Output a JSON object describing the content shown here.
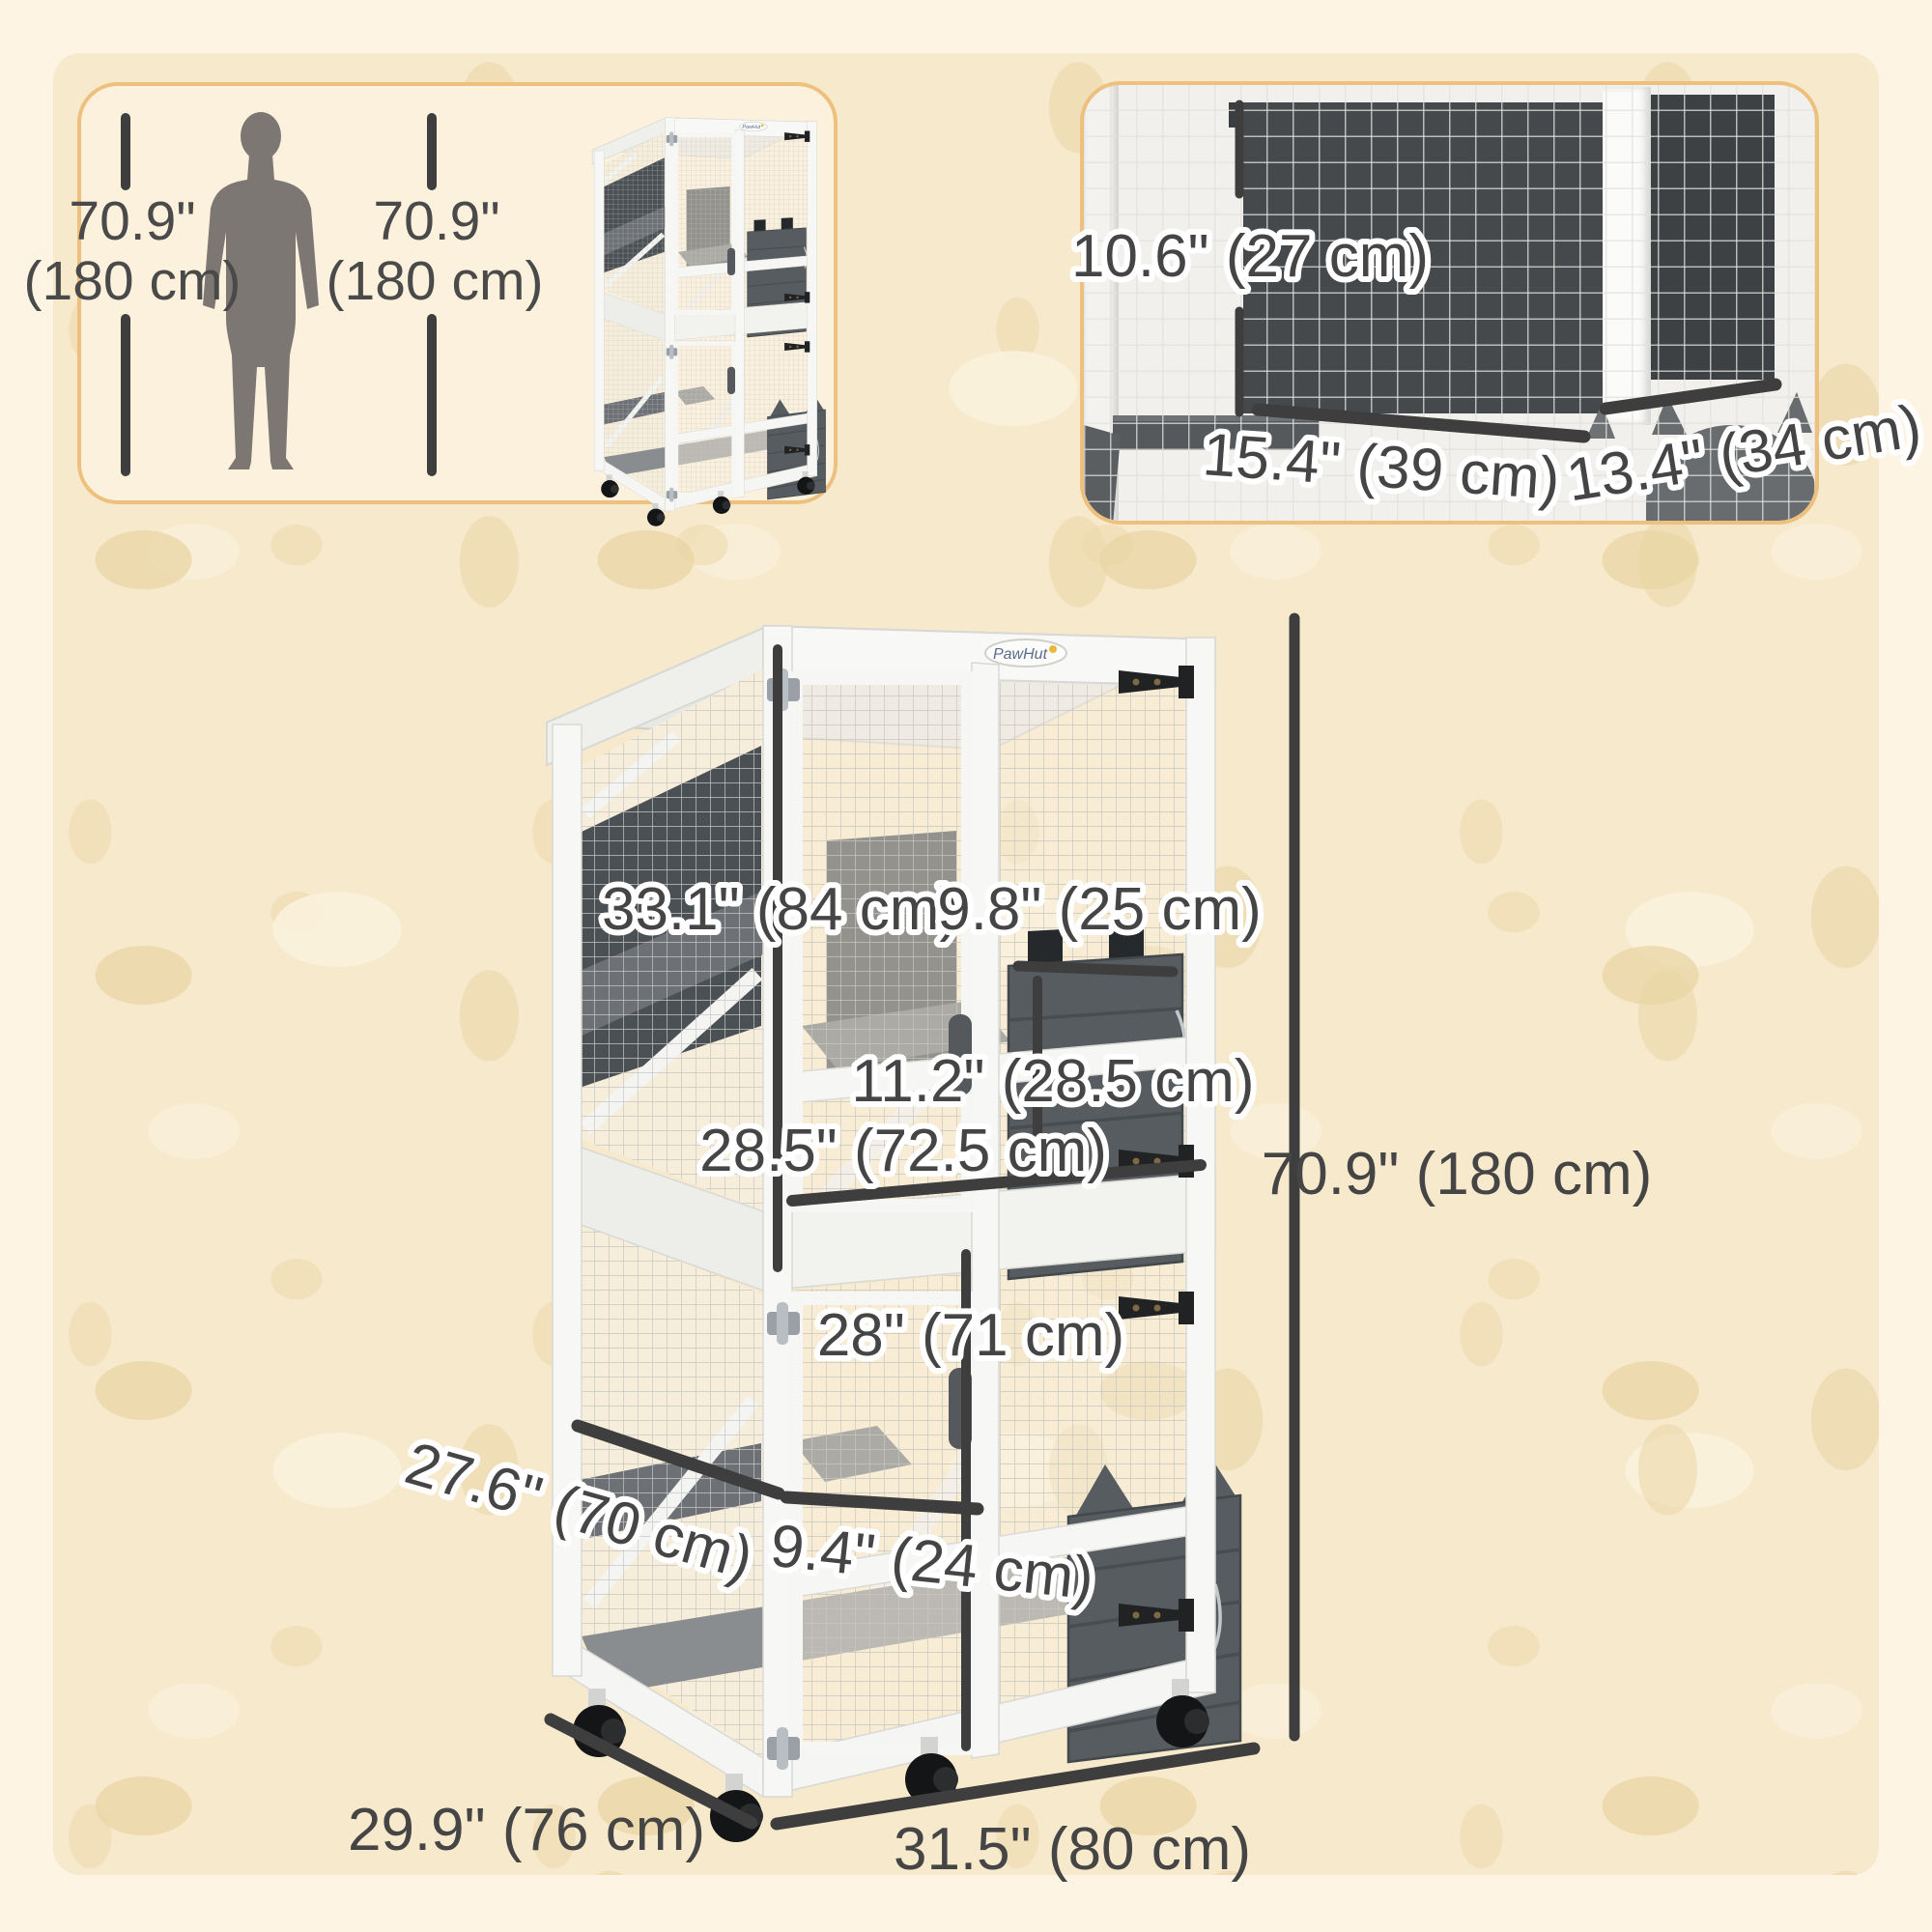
{
  "colors": {
    "panel_border": "#eec07e",
    "texture_background": "#f7e9cc",
    "dimension_line": "#3e3e3e",
    "cage_gray": "#575c60"
  },
  "scale_panel": {
    "left_measure_in": "70.9\"",
    "left_measure_cm": "(180 cm)",
    "right_measure_in": "70.9\"",
    "right_measure_cm": "(180 cm)"
  },
  "detail_panel": {
    "opening_height": "10.6\" (27 cm)",
    "left_opening_width": "15.4\" (39 cm)",
    "right_opening_width": "13.4\" (34 cm)"
  },
  "diagram": {
    "brand": "PawHut",
    "upper_tier_height": "33.1\" (84 cm)",
    "upper_door_width": "9.8\" (25 cm)",
    "cat_door_height": "11.2\" (28.5 cm)",
    "upper_front_width": "28.5\" (72.5 cm)",
    "lower_tier_height": "28\" (71 cm)",
    "platform_depth": "27.6\" (70 cm)",
    "lower_door_width": "9.4\" (24 cm)",
    "overall_height": "70.9\" (180 cm)",
    "base_depth": "29.9\" (76 cm)",
    "base_width": "31.5\" (80 cm)"
  }
}
